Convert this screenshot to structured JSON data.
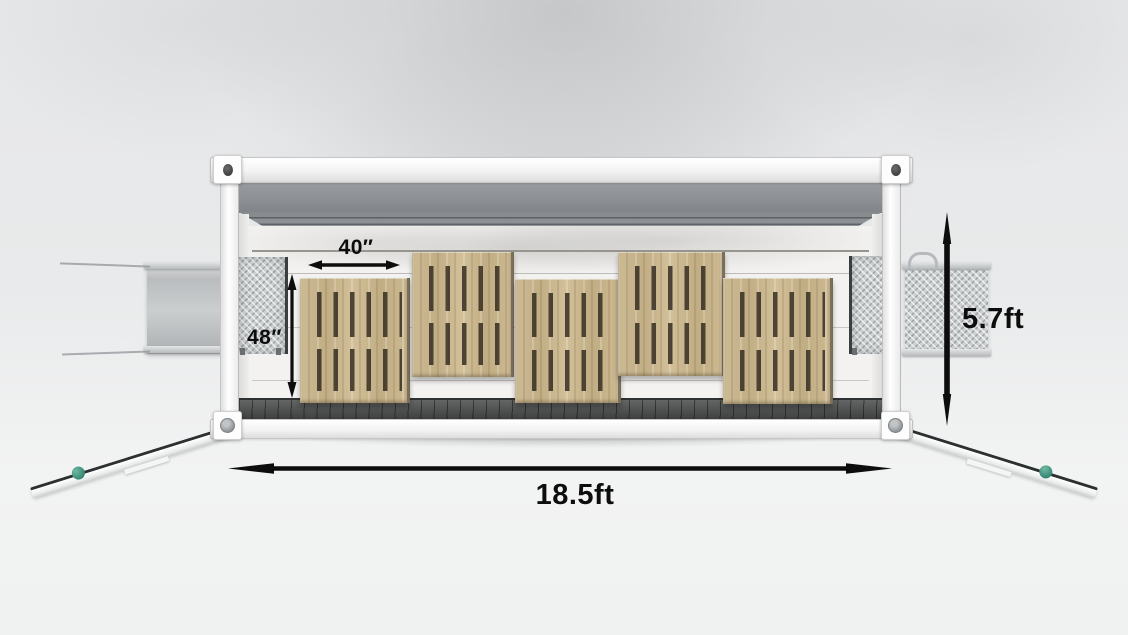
{
  "scene": {
    "subject": "shipping-container-cutaway-with-pallets",
    "pallet_count": 5
  },
  "dimensions": {
    "pallet_width": {
      "label": "40″"
    },
    "pallet_depth": {
      "label": "48″"
    },
    "container_height": {
      "label": "5.7ft"
    },
    "container_length": {
      "label": "18.5ft"
    }
  },
  "icons": {
    "horizontal_dimension_arrow": "tapered-double-headed-arrow",
    "vertical_dimension_arrow": "tapered-double-headed-arrow",
    "corner_casting_hole": "oval",
    "ramp_roller": "circle"
  },
  "colors": {
    "dimension_arrow": "#0d0d0d",
    "dimension_text": "#0d0d0d",
    "pallet_wood": "#c9b58d",
    "pallet_slot": "#2f271d",
    "floor": "#4a4d4c",
    "ceiling_fascia": "#8f9297",
    "container_frame": "#fafafa",
    "loading_plate": "#ccd0d1",
    "ramp_roller_accent": "#3d8f7b",
    "background": "#e9eaeb"
  }
}
